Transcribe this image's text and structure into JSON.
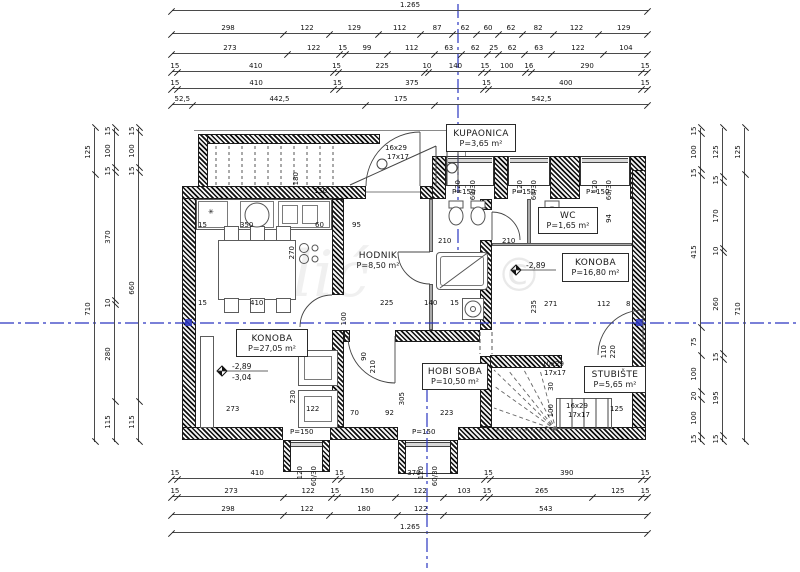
{
  "drawing": {
    "watermark": {
      "text": "Bilić",
      "copyright": "©"
    },
    "axis_color": "#2a35c0",
    "rooms": [
      {
        "name": "KUPAONICA",
        "area": "P=3,65 m²",
        "x": 446,
        "y": 124,
        "w": 70,
        "h": 28,
        "boxed": true
      },
      {
        "name": "WC",
        "area": "P=1,65 m²",
        "x": 538,
        "y": 207,
        "w": 60,
        "h": 27,
        "boxed": true
      },
      {
        "name": "KONOBA",
        "area": "P=16,80 m²",
        "x": 562,
        "y": 253,
        "w": 67,
        "h": 29,
        "boxed": true
      },
      {
        "name": "HODNIK",
        "area": "P=8,50 m²",
        "x": 349,
        "y": 247,
        "w": 58,
        "h": 26,
        "boxed": false
      },
      {
        "name": "KONOBA",
        "area": "P=27,05 m²",
        "x": 236,
        "y": 329,
        "w": 72,
        "h": 28,
        "boxed": true
      },
      {
        "name": "HOBI SOBA",
        "area": "P=10,50 m²",
        "x": 422,
        "y": 363,
        "w": 66,
        "h": 27,
        "boxed": true
      },
      {
        "name": "STUBIŠTE",
        "area": "P=5,65 m²",
        "x": 584,
        "y": 366,
        "w": 62,
        "h": 27,
        "boxed": true
      }
    ],
    "levels": [
      {
        "t": "-2,89",
        "x": 232,
        "y": 363
      },
      {
        "t": "-3,04",
        "x": 232,
        "y": 374
      },
      {
        "t": "-2,89",
        "x": 526,
        "y": 262
      }
    ],
    "dims": {
      "top": [
        [
          "1.265"
        ],
        [
          "298",
          "122",
          "129",
          "112",
          "87",
          "62",
          "60",
          "62",
          "82",
          "122",
          "129"
        ],
        [
          "273",
          "122",
          "15",
          "99",
          "112",
          "63",
          "62",
          "25",
          "62",
          "63",
          "122",
          "104"
        ],
        [
          "15",
          "410",
          "15",
          "225",
          "10",
          "140",
          "15",
          "100",
          "16",
          "290",
          "15"
        ],
        [
          "15",
          "410",
          "15",
          "375",
          "15",
          "400",
          "15"
        ],
        [
          "52,5",
          "442,5",
          "175",
          "542,5"
        ]
      ],
      "bottom": [
        [
          "15",
          "410",
          "15",
          "370",
          "15",
          "390",
          "15"
        ],
        [
          "15",
          "273",
          "122",
          "15",
          "150",
          "122",
          "103",
          "15",
          "265",
          "125",
          "15"
        ],
        [
          "298",
          "122",
          "180",
          "122",
          "543"
        ],
        [
          "1.265"
        ]
      ],
      "left": [
        [
          "125",
          "710"
        ],
        [
          "15",
          "100",
          "15",
          "370",
          "10",
          "280",
          "115"
        ],
        [
          "15",
          "100",
          "15",
          "660",
          "115"
        ]
      ],
      "right": [
        [
          "15",
          "100",
          "15",
          "415",
          "75",
          "100",
          "20",
          "100",
          "15"
        ],
        [
          "125",
          "15",
          "170",
          "10",
          "260",
          "15",
          "195",
          "15"
        ],
        [
          "125",
          "710"
        ]
      ]
    },
    "labels": [
      {
        "t": "150",
        "x": 314,
        "y": 188
      },
      {
        "t": "15",
        "x": 198,
        "y": 222
      },
      {
        "t": "350",
        "x": 240,
        "y": 222
      },
      {
        "t": "60",
        "x": 315,
        "y": 222
      },
      {
        "t": "95",
        "x": 352,
        "y": 222
      },
      {
        "t": "270",
        "x": 289,
        "y": 246,
        "r": 1
      },
      {
        "t": "180",
        "x": 293,
        "y": 172,
        "r": 1
      },
      {
        "t": "15",
        "x": 198,
        "y": 300
      },
      {
        "t": "410",
        "x": 250,
        "y": 300
      },
      {
        "t": "100",
        "x": 341,
        "y": 312,
        "r": 1
      },
      {
        "t": "225",
        "x": 380,
        "y": 300
      },
      {
        "t": "140",
        "x": 424,
        "y": 300
      },
      {
        "t": "15",
        "x": 450,
        "y": 300
      },
      {
        "t": "271",
        "x": 544,
        "y": 301
      },
      {
        "t": "235",
        "x": 531,
        "y": 300,
        "r": 1
      },
      {
        "t": "112",
        "x": 597,
        "y": 301
      },
      {
        "t": "8",
        "x": 626,
        "y": 301
      },
      {
        "t": "210",
        "x": 438,
        "y": 238
      },
      {
        "t": "210",
        "x": 502,
        "y": 238
      },
      {
        "t": "94",
        "x": 606,
        "y": 214,
        "r": 1
      },
      {
        "t": "120",
        "x": 455,
        "y": 180,
        "r": 1
      },
      {
        "t": "60/30",
        "x": 470,
        "y": 180,
        "r": 1
      },
      {
        "t": "P=150",
        "x": 452,
        "y": 189
      },
      {
        "t": "120",
        "x": 517,
        "y": 180,
        "r": 1
      },
      {
        "t": "60/30",
        "x": 531,
        "y": 180,
        "r": 1
      },
      {
        "t": "P=150",
        "x": 512,
        "y": 189
      },
      {
        "t": "120",
        "x": 592,
        "y": 180,
        "r": 1
      },
      {
        "t": "60/30",
        "x": 606,
        "y": 180,
        "r": 1
      },
      {
        "t": "P=150",
        "x": 586,
        "y": 189
      },
      {
        "t": "P=150",
        "x": 290,
        "y": 429
      },
      {
        "t": "120",
        "x": 297,
        "y": 466,
        "r": 1
      },
      {
        "t": "60/30",
        "x": 311,
        "y": 466,
        "r": 1
      },
      {
        "t": "P=150",
        "x": 412,
        "y": 429
      },
      {
        "t": "120",
        "x": 418,
        "y": 466,
        "r": 1
      },
      {
        "t": "60/30",
        "x": 432,
        "y": 466,
        "r": 1
      },
      {
        "t": "273",
        "x": 226,
        "y": 406
      },
      {
        "t": "230",
        "x": 290,
        "y": 390,
        "r": 1
      },
      {
        "t": "122",
        "x": 306,
        "y": 406
      },
      {
        "t": "70",
        "x": 350,
        "y": 410
      },
      {
        "t": "92",
        "x": 385,
        "y": 410
      },
      {
        "t": "223",
        "x": 440,
        "y": 410
      },
      {
        "t": "305",
        "x": 399,
        "y": 392,
        "r": 1
      },
      {
        "t": "90",
        "x": 361,
        "y": 352,
        "r": 1
      },
      {
        "t": "210",
        "x": 370,
        "y": 360,
        "r": 1
      },
      {
        "t": "110",
        "x": 601,
        "y": 345,
        "r": 1
      },
      {
        "t": "220",
        "x": 610,
        "y": 345,
        "r": 1
      },
      {
        "t": "100",
        "x": 548,
        "y": 404,
        "r": 1
      },
      {
        "t": "30",
        "x": 548,
        "y": 382,
        "r": 1
      },
      {
        "t": "125",
        "x": 610,
        "y": 406
      },
      {
        "t": "16x29",
        "x": 385,
        "y": 145
      },
      {
        "t": "17x17",
        "x": 387,
        "y": 154
      },
      {
        "t": "10x29",
        "x": 542,
        "y": 361
      },
      {
        "t": "17x17",
        "x": 544,
        "y": 370
      },
      {
        "t": "16x29",
        "x": 566,
        "y": 403
      },
      {
        "t": "17x17",
        "x": 568,
        "y": 412
      },
      {
        "t": "✳",
        "x": 208,
        "y": 209
      }
    ],
    "chain_geo": {
      "top": {
        "x": 172,
        "w": 476,
        "ys": [
          10,
          33,
          53,
          71,
          88,
          104
        ]
      },
      "bottom": {
        "x": 172,
        "w": 476,
        "ys": [
          478,
          496,
          514,
          532
        ]
      },
      "left": {
        "y": 128,
        "h": 314,
        "xs": [
          94,
          114,
          138
        ]
      },
      "right": {
        "y": 128,
        "h": 314,
        "xs": [
          700,
          722,
          744
        ]
      }
    }
  }
}
